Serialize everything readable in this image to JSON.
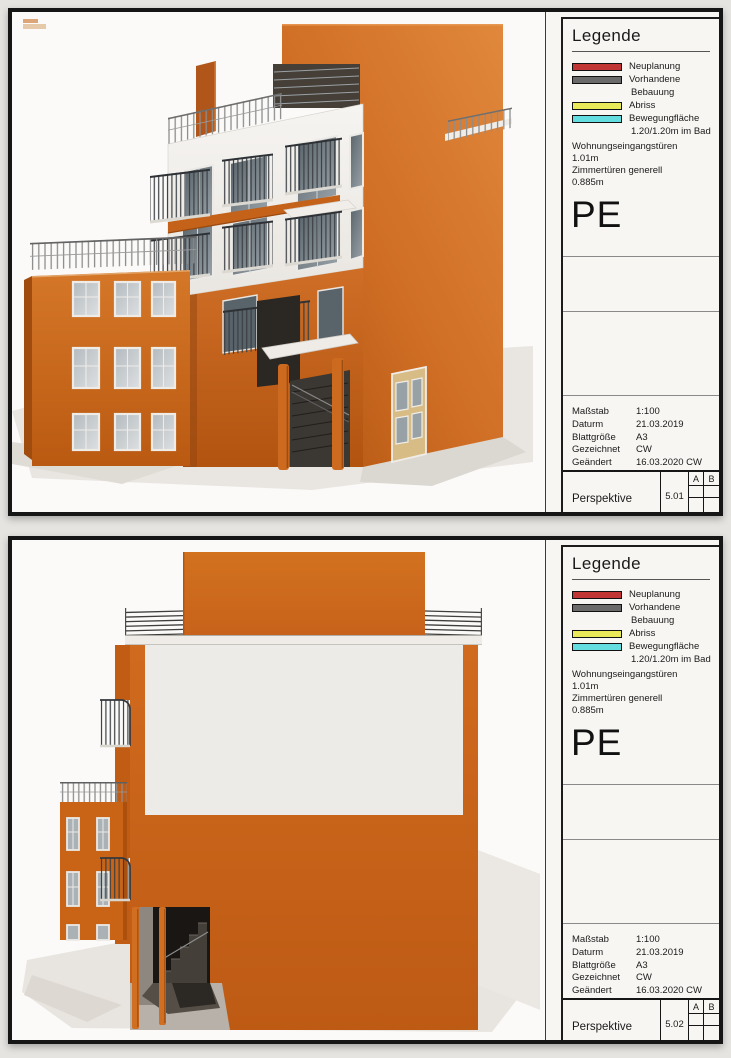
{
  "legend": {
    "title": "Legende",
    "items": [
      {
        "swatch_color": "#c23535",
        "label": "Neuplanung",
        "label2": ""
      },
      {
        "swatch_color": "#6a6a6a",
        "label": "Vorhandene",
        "label2": "Bebauung"
      },
      {
        "swatch_color": "#e9e95a",
        "label": "Abriss",
        "label2": ""
      },
      {
        "swatch_color": "#64dde0",
        "label": "Bewegungfläche",
        "label2": "1.20/1.20m im Bad"
      }
    ],
    "notes": [
      "Wohnungseingangstüren",
      "1.01m",
      "Zimmertüren generell",
      "0.885m"
    ],
    "code": "PE"
  },
  "titleblock": {
    "rows": [
      {
        "label": "Maßstab",
        "value": "1:100"
      },
      {
        "label": "Daturm",
        "value": "21.03.2019"
      },
      {
        "label": "Blattgröße",
        "value": "A3"
      },
      {
        "label": "Gezeichnet",
        "value": "CW"
      },
      {
        "label": "Geändert",
        "value": "16.03.2020 CW"
      }
    ],
    "revision_columns": [
      "A",
      "B"
    ]
  },
  "sheets": [
    {
      "view_label": "Perspektive",
      "sheet_number": "5.01"
    },
    {
      "view_label": "Perspektive",
      "sheet_number": "5.02"
    }
  ],
  "colors": {
    "building_orange": "#cc671e",
    "facade_white": "#f0eeea",
    "glass_gray": "#8a949a",
    "legend_red": "#c23535",
    "legend_gray": "#6a6a6a",
    "legend_yellow": "#e9e95a",
    "legend_cyan": "#64dde0",
    "paper": "#f8f6f3",
    "background": "#e6e4e1"
  }
}
